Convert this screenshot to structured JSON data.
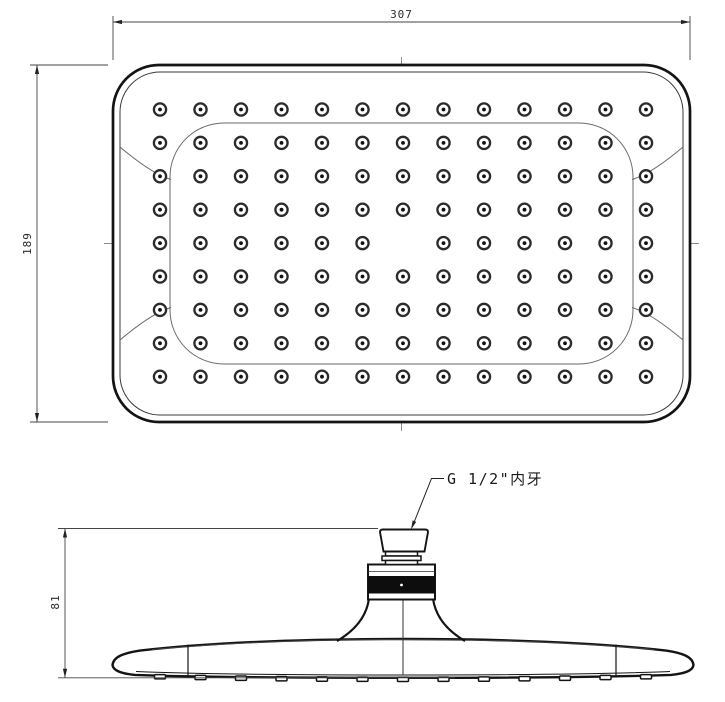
{
  "drawing_title": "shower head technical drawing",
  "colors": {
    "outline": "#141414",
    "thin_line": "#555555",
    "centerline": "#8c8c8c",
    "dimension_line": "#444444",
    "band_fill": "#0d0d0d",
    "background": "#ffffff"
  },
  "top_view": {
    "dim_width": "307",
    "dim_height": "189",
    "nozzle_grid": {
      "columns": 13,
      "rows": 9,
      "origin_x": 160,
      "origin_y": 109.5,
      "col_spacing": 40.5,
      "row_spacing": 33.4,
      "omit_center": true,
      "outer_radius": 6.1,
      "ring_stroke": 2.3,
      "dot_radius": 1.9,
      "total_nozzles": 116
    }
  },
  "side_view": {
    "dim_height": "81",
    "connector_label": "G 1/2\"内牙",
    "bumps": {
      "count": 13,
      "origin_x": 160,
      "spacing": 40.5,
      "width": 11,
      "height": 4.3
    }
  }
}
